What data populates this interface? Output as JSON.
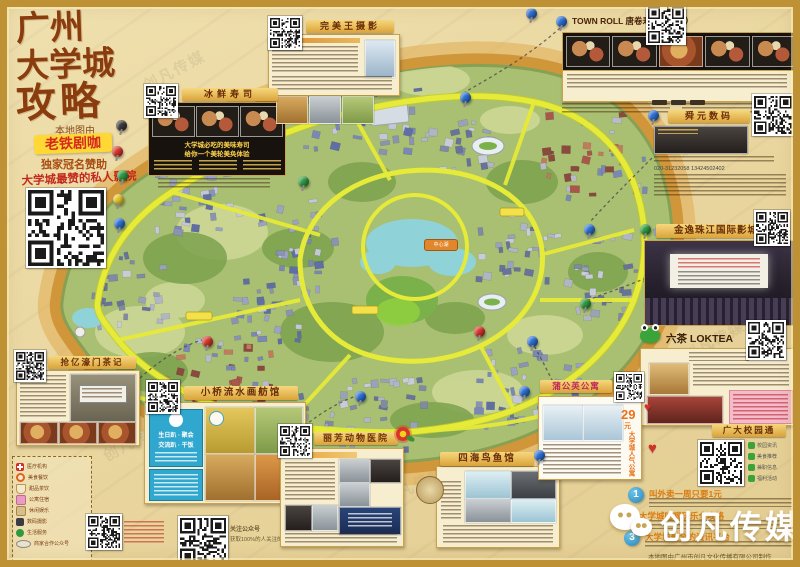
{
  "poster": {
    "title_line1": "广州",
    "title_line2": "大学城",
    "title_line3": "攻略",
    "byline": "本地图由",
    "sponsor_name": "老铁剧咖",
    "sponsor_role": "独家冠名赞助",
    "sponsor_tagline": "大学城最赞的私人影院",
    "brand": "创凡传媒",
    "credit": "本地图由广州市创凡文化传播有限公司制作"
  },
  "callouts": {
    "sushi_fresh": {
      "title": "冰鲜寿司",
      "line1": "大学城必吃的美味寿司",
      "line2": "给你一个美轮美奂体验"
    },
    "photo_studio": {
      "title": "完美王摄影"
    },
    "town_roll": {
      "title": "TOWN ROLL 唐卷寿司（茶饮）"
    },
    "shunyuan": {
      "title": "舜元数码",
      "phone": "020-31232058  13424502402"
    },
    "jinyi": {
      "title": "金逸珠江国际影城"
    },
    "loktea": {
      "title": "六茶 LOKTEA"
    },
    "campus_pass": {
      "title": "广大校园通",
      "rows": [
        {
          "label": "校园资讯"
        },
        {
          "label": "美食推荐"
        },
        {
          "label": "兼职信息"
        },
        {
          "label": "福利活动"
        }
      ]
    },
    "haomen_tea": {
      "title": "抢亿濠门茶记"
    },
    "boat_hall": {
      "title": "小桥流水画舫馆",
      "blue_line1": "生日趴 · 聚会",
      "blue_line2": "交流趴 · 干饭"
    },
    "lifang_vet": {
      "title": "丽芳动物医院"
    },
    "sihai": {
      "title": "四海鸟鱼馆"
    },
    "dandelion": {
      "title": "蒲公英公寓",
      "price": "29",
      "price_unit": "元",
      "vertical_note": "大学城人气公寓"
    }
  },
  "bottom_list": {
    "items": [
      {
        "num": "1",
        "heading": "叫外卖一周只要1元"
      },
      {
        "num": "2",
        "heading": "大学城吃喝玩乐全攻略"
      },
      {
        "num": "3",
        "heading": "大学城最全的资讯平台"
      }
    ]
  },
  "legend": {
    "items": [
      {
        "label": "医疗机构"
      },
      {
        "label": "美食餐饮"
      },
      {
        "label": "甜品茶饮"
      },
      {
        "label": "公寓住宿"
      },
      {
        "label": "休闲娱乐"
      },
      {
        "label": "数码摄影"
      },
      {
        "label": "生活服务"
      },
      {
        "label": "商家合作公众号"
      }
    ]
  },
  "qr_note": {
    "line1": "关注公众号",
    "line2": "获取100%的人关注的福利"
  },
  "map": {
    "center_label": "中心湖"
  }
}
